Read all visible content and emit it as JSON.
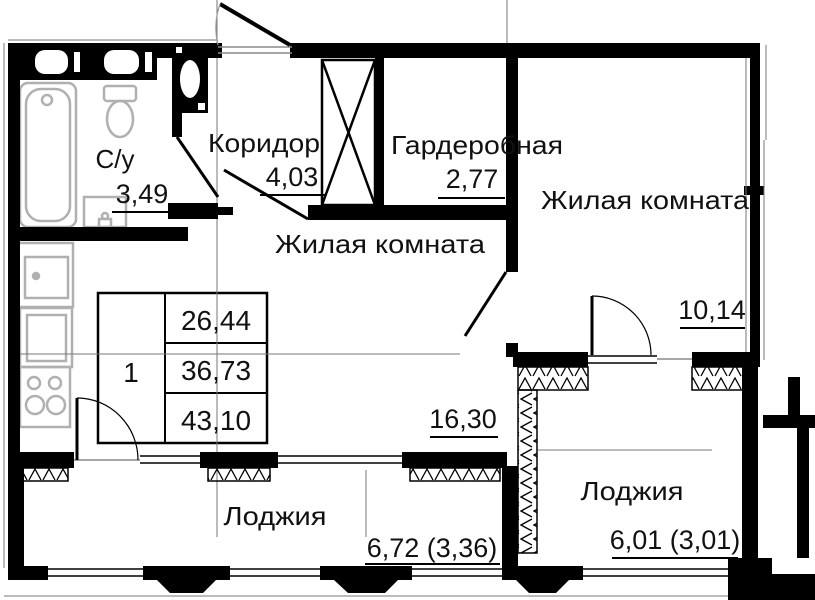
{
  "unit": {
    "number": "1",
    "area_living": "26,44",
    "area_main": "36,73",
    "area_total": "43,10"
  },
  "rooms": {
    "bathroom": {
      "name": "С/у",
      "area": "3,49"
    },
    "corridor": {
      "name": "Коридор",
      "area": "4,03"
    },
    "wardrobe": {
      "name": "Гардеробная",
      "area": "2,77"
    },
    "living_main": {
      "name": "Жилая комната",
      "area": "16,30"
    },
    "living_second": {
      "name": "Жилая комната",
      "area": "10,14"
    },
    "loggia_left": {
      "name": "Лоджия",
      "area": "6,72 (3,36)"
    },
    "loggia_right": {
      "name": "Лоджия",
      "area": "6,01 (3,01)"
    }
  },
  "colors": {
    "wall": "#000000",
    "fixture": "#b0b0b0",
    "thin_line": "#777777",
    "background": "#ffffff"
  }
}
